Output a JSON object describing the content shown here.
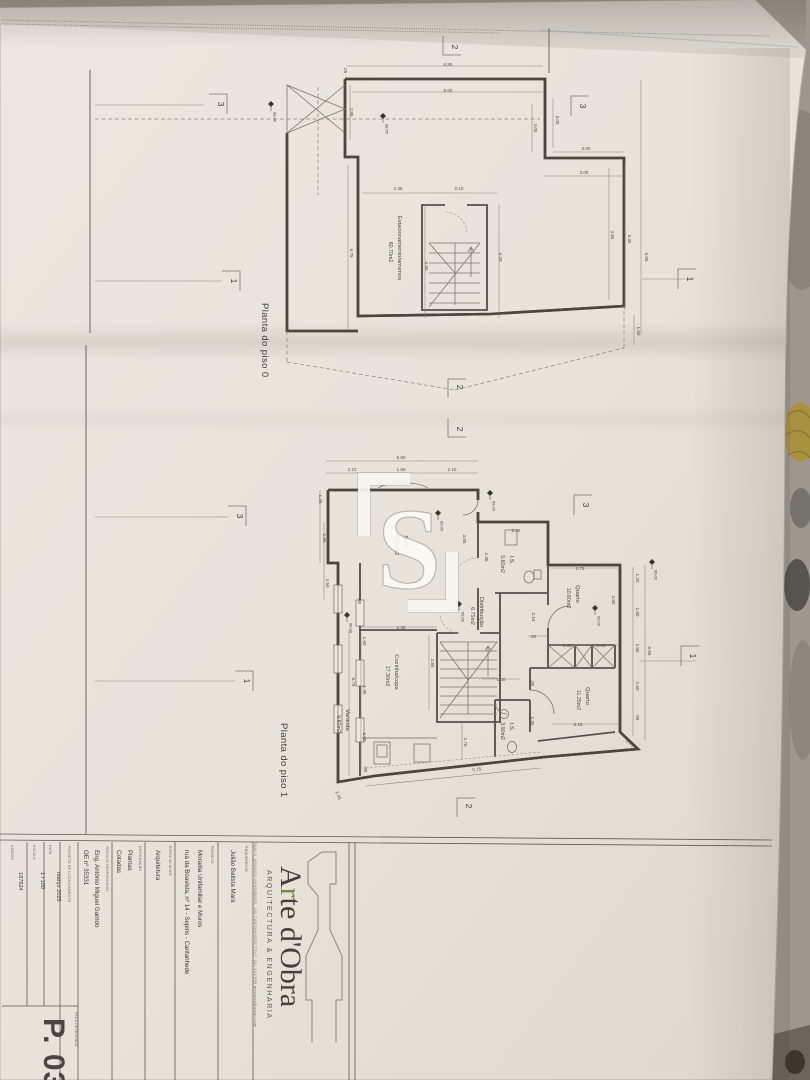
{
  "photo": {
    "background_color": "#9d988f",
    "paper_color": "#e9e4dc",
    "accent_green": "#77883b",
    "gold_object_color": "#a8923f"
  },
  "watermark": {
    "letter": "S"
  },
  "plans": [
    {
      "id": "piso0",
      "title": {
        "t": "Planta do piso 0",
        "x": 262,
        "y": 303
      },
      "rooms": [
        {
          "name": "Estacionamento/arrumos",
          "area": "60.70m2",
          "x": 398,
          "y": 248
        }
      ],
      "dims": [
        {
          "t": "6.85",
          "x": 448,
          "y": 66,
          "o": "h"
        },
        {
          "t": ".25",
          "x": 344,
          "y": 70,
          "o": "v"
        },
        {
          "t": "6.60",
          "x": 448,
          "y": 92,
          "o": "h"
        },
        {
          "t": "2.85",
          "x": 350,
          "y": 112,
          "o": "v"
        },
        {
          "t": "3.00",
          "x": 556,
          "y": 120,
          "o": "v"
        },
        {
          "t": "3.00",
          "x": 534,
          "y": 128,
          "o": "v"
        },
        {
          "t": "3.00",
          "x": 586,
          "y": 150,
          "o": "h"
        },
        {
          "t": "3.00",
          "x": 584,
          "y": 174,
          "o": "h"
        },
        {
          "t": "2.35",
          "x": 398,
          "y": 190,
          "o": "h"
        },
        {
          "t": "2.10",
          "x": 459,
          "y": 190,
          "o": "h"
        },
        {
          "t": "6.75",
          "x": 350,
          "y": 253,
          "o": "v"
        },
        {
          "t": "4.50",
          "x": 425,
          "y": 266,
          "o": "v"
        },
        {
          "t": "4.20",
          "x": 499,
          "y": 257,
          "o": "v"
        },
        {
          "t": "4.85",
          "x": 611,
          "y": 235,
          "o": "v"
        },
        {
          "t": "5.35",
          "x": 628,
          "y": 239,
          "o": "v"
        },
        {
          "t": "6.85",
          "x": 645,
          "y": 257,
          "o": "v"
        },
        {
          "t": "1.50",
          "x": 637,
          "y": 331,
          "o": "v"
        }
      ],
      "sections": [
        {
          "n": "2",
          "x": 452,
          "y": 47,
          "d": "t"
        },
        {
          "n": "3",
          "x": 218,
          "y": 104,
          "d": "l"
        },
        {
          "n": "3",
          "x": 580,
          "y": 106,
          "d": "r"
        },
        {
          "n": "1",
          "x": 231,
          "y": 281,
          "d": "l"
        },
        {
          "n": "1",
          "x": 687,
          "y": 279,
          "d": "r"
        },
        {
          "n": "2",
          "x": 457,
          "y": 387,
          "d": "b"
        }
      ],
      "levels": [
        {
          "v": "98.40",
          "x": 271,
          "y": 104
        },
        {
          "v": "98.55",
          "x": 383,
          "y": 116
        }
      ]
    },
    {
      "id": "piso1",
      "title": {
        "t": "Planta do piso 1",
        "x": 281,
        "y": 723
      },
      "rooms": [
        {
          "name": "Sala",
          "area": "20.90m2",
          "x": 404,
          "y": 541
        },
        {
          "name": "I.S.",
          "area": "5.60m2",
          "x": 510,
          "y": 560
        },
        {
          "name": "Quarto",
          "area": "10.60m2",
          "x": 576,
          "y": 594
        },
        {
          "name": "Distribuição",
          "area": "6.75m2",
          "x": 480,
          "y": 612
        },
        {
          "name": "Cozinha/copa",
          "area": "17.30m2",
          "x": 395,
          "y": 672
        },
        {
          "name": "Varanda",
          "area": "9.60m2",
          "x": 346,
          "y": 720
        },
        {
          "name": "I.S.",
          "area": "3.90m2",
          "x": 510,
          "y": 727
        },
        {
          "name": "Quarto",
          "area": "11.25m2",
          "x": 586,
          "y": 696
        }
      ],
      "dims": [
        {
          "t": "5.80",
          "x": 401,
          "y": 459,
          "o": "h"
        },
        {
          "t": "2.10",
          "x": 352,
          "y": 471,
          "o": "h"
        },
        {
          "t": "1.60",
          "x": 401,
          "y": 471,
          "o": "h"
        },
        {
          "t": "2.10",
          "x": 452,
          "y": 471,
          "o": "h"
        },
        {
          "t": "1.25",
          "x": 319,
          "y": 499,
          "o": "v"
        },
        {
          "t": "1.60",
          "x": 323,
          "y": 538,
          "o": "v"
        },
        {
          "t": "1.50",
          "x": 326,
          "y": 583,
          "o": "v"
        },
        {
          "t": "3.85",
          "x": 463,
          "y": 539,
          "o": "v"
        },
        {
          "t": "2.35",
          "x": 485,
          "y": 557,
          "o": "v"
        },
        {
          "t": "2.35",
          "x": 516,
          "y": 532,
          "o": "h"
        },
        {
          "t": "2.75",
          "x": 580,
          "y": 570,
          "o": "h"
        },
        {
          "t": "1.20",
          "x": 636,
          "y": 578,
          "o": "v"
        },
        {
          "t": "2.80",
          "x": 612,
          "y": 600,
          "o": "v"
        },
        {
          "t": "1.60",
          "x": 636,
          "y": 612,
          "o": "v"
        },
        {
          "t": "2.10",
          "x": 532,
          "y": 617,
          "o": "v"
        },
        {
          "t": ".80",
          "x": 358,
          "y": 601,
          "o": "v"
        },
        {
          "t": "1.50",
          "x": 636,
          "y": 648,
          "o": "v"
        },
        {
          "t": "6.85",
          "x": 648,
          "y": 651,
          "o": "v"
        },
        {
          "t": ".80",
          "x": 533,
          "y": 638,
          "o": "h"
        },
        {
          "t": "1.35",
          "x": 567,
          "y": 647,
          "o": "h"
        },
        {
          "t": "1.00",
          "x": 601,
          "y": 647,
          "o": "h"
        },
        {
          "t": "1.60",
          "x": 636,
          "y": 686,
          "o": "v"
        },
        {
          "t": ".95",
          "x": 636,
          "y": 717,
          "o": "v"
        },
        {
          "t": "3.15",
          "x": 578,
          "y": 726,
          "o": "h"
        },
        {
          "t": "2.35",
          "x": 401,
          "y": 629,
          "o": "h"
        },
        {
          "t": "2.85",
          "x": 431,
          "y": 663,
          "o": "v"
        },
        {
          "t": "1.00",
          "x": 501,
          "y": 681,
          "o": "h"
        },
        {
          "t": "1.95",
          "x": 363,
          "y": 690,
          "o": "v"
        },
        {
          "t": "6.75",
          "x": 352,
          "y": 682,
          "o": "v"
        },
        {
          "t": "1.60",
          "x": 363,
          "y": 641,
          "o": "v"
        },
        {
          "t": "1.60",
          "x": 363,
          "y": 737,
          "o": "v"
        },
        {
          "t": ".80",
          "x": 364,
          "y": 769,
          "o": "v"
        },
        {
          "t": "1.75",
          "x": 464,
          "y": 742,
          "o": "v"
        },
        {
          "t": ".95",
          "x": 531,
          "y": 683,
          "o": "v"
        },
        {
          "t": "1.35",
          "x": 531,
          "y": 721,
          "o": "v"
        },
        {
          "t": "5.75",
          "x": 477,
          "y": 771,
          "r": -6
        },
        {
          "t": "3.20",
          "x": 629,
          "y": 744,
          "r": 40
        },
        {
          "t": "2.45",
          "x": 337,
          "y": 796,
          "r": 68
        }
      ],
      "sections": [
        {
          "n": "2",
          "x": 457,
          "y": 429,
          "d": "t"
        },
        {
          "n": "3",
          "x": 237,
          "y": 516,
          "d": "l"
        },
        {
          "n": "3",
          "x": 583,
          "y": 505,
          "d": "r"
        },
        {
          "n": "1",
          "x": 244,
          "y": 681,
          "d": "l"
        },
        {
          "n": "1",
          "x": 690,
          "y": 656,
          "d": "r"
        },
        {
          "n": "2",
          "x": 466,
          "y": 806,
          "d": "b"
        }
      ],
      "levels": [
        {
          "v": "99.00",
          "x": 490,
          "y": 493
        },
        {
          "v": "99.00",
          "x": 438,
          "y": 513
        },
        {
          "v": "98.90",
          "x": 347,
          "y": 615
        },
        {
          "v": "99.00",
          "x": 459,
          "y": 604
        },
        {
          "v": "99.00",
          "x": 595,
          "y": 608
        },
        {
          "v": "99.00",
          "x": 652,
          "y": 562
        }
      ]
    }
  ],
  "title_block": {
    "logo": {
      "brand_segments": [
        {
          "t": "A",
          "accent": false
        },
        {
          "t": "r",
          "accent": true
        },
        {
          "t": "te d'Obra",
          "accent": false
        }
      ],
      "tagline": "ARQUITECTURA  &  ENGENHARIA",
      "address": "RUA D. AFONSO HENRIQUES, 102 CANTANHEDE      TELF. 231 423 999      arteobra@gmail.com"
    },
    "fields": [
      {
        "label": "CÓDIGO",
        "lx": 11,
        "ly": 845,
        "values": [
          {
            "t": "187624",
            "x": 19,
            "y": 872,
            "s": "small"
          }
        ]
      },
      {
        "label": "ESCALA",
        "lx": 33,
        "ly": 845,
        "values": [
          {
            "t": "1 / 100",
            "x": 41,
            "y": 872,
            "s": "small"
          }
        ]
      },
      {
        "label": "DATA",
        "lx": 49,
        "ly": 845,
        "values": [
          {
            "t": "março 2025",
            "x": 57,
            "y": 872,
            "s": "small"
          }
        ]
      },
      {
        "label": "PROJETO DE LICENCIAMENTO",
        "lx": 68,
        "ly": 846,
        "values": []
      },
      {
        "label": "TÉCNICO RESPONSÁVEL",
        "lx": 106,
        "ly": 846,
        "values": [
          {
            "t": "Eng. António Miguel Garrido",
            "x": 95,
            "y": 850
          },
          {
            "t": "OE nº 35331",
            "x": 84,
            "y": 850
          }
        ]
      },
      {
        "label": "DESIGNAÇÃO",
        "lx": 139,
        "ly": 846,
        "values": [
          {
            "t": "Plantas",
            "x": 128,
            "y": 850
          },
          {
            "t": "Cotadas",
            "x": 117,
            "y": 850
          }
        ]
      },
      {
        "label": "ESPECIALIDADE",
        "lx": 169,
        "ly": 846,
        "values": [
          {
            "t": "Arquitetura",
            "x": 156,
            "y": 850
          }
        ]
      },
      {
        "label": "PROJETO",
        "lx": 211,
        "ly": 846,
        "values": [
          {
            "t": "Moradia Unifamiliar e Muros",
            "x": 198,
            "y": 850
          },
          {
            "t": "rua da Boavista, nº 14 - Sepins - Cantanhede",
            "x": 185,
            "y": 850
          }
        ]
      },
      {
        "label": "REQUERENTE",
        "lx": 245,
        "ly": 846,
        "values": [
          {
            "t": "Julião Batista Marà",
            "x": 231,
            "y": 850
          }
        ]
      }
    ],
    "piece": {
      "label": "PEÇA DESENHADA",
      "lx": 75,
      "ly": 1012,
      "number": "P. 03",
      "nx": 44,
      "ny": 1018
    }
  }
}
